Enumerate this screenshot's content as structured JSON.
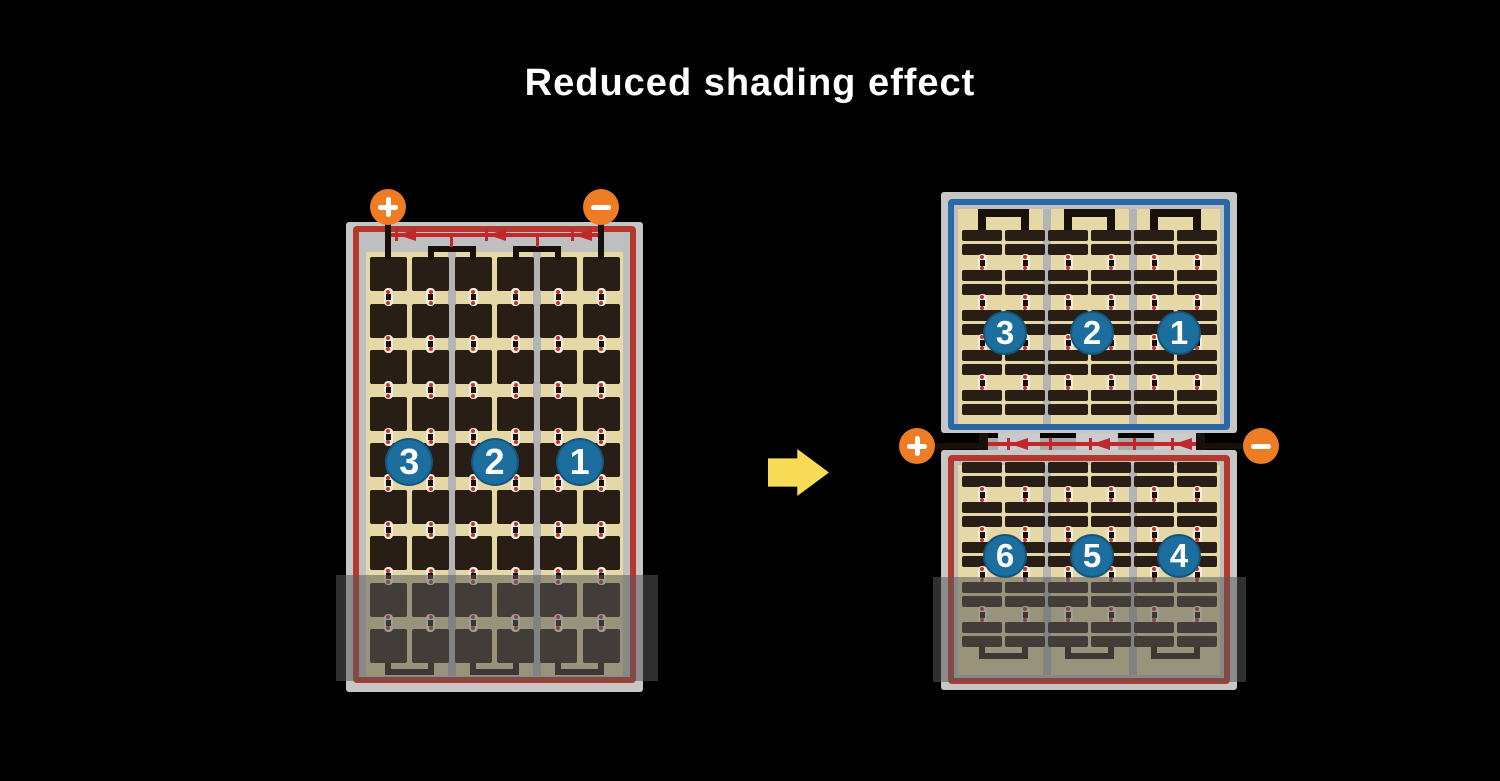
{
  "title": "Reduced shading effect",
  "colors": {
    "background": "#000000",
    "title_text": "#FFFFFF",
    "panel_frame": "#C6C6C6",
    "panel_inner": "#BFBFBF",
    "cell_field_tan": "#E6D8A6",
    "cell_dark": "#281E15",
    "divider_gray": "#B4B4B4",
    "border_red": "#B5382D",
    "border_blue": "#2A68A6",
    "wire_red": "#C1282D",
    "wire_black": "#17100B",
    "terminal_orange": "#EE7C25",
    "string_badge_blue": "#1C6E9E",
    "connector_white": "#F2EDDE",
    "connector_red": "#C3322A",
    "connector_black": "#191009",
    "junction_link_gray": "#A9A9A9",
    "junction_pad_gray": "#CACACA",
    "arrow_yellow": "#F8DC57",
    "shade_overlay": "rgba(88,88,88,0.54)"
  },
  "left_figure": {
    "panel": {
      "border_color": "red",
      "sections": 3,
      "columns_per_section": 2,
      "cell_rows": 9,
      "cell_type": "full-cell",
      "strings": [
        {
          "label": "3"
        },
        {
          "label": "2"
        },
        {
          "label": "1"
        }
      ],
      "bypass_diodes": 3,
      "shaded_bottom": true
    },
    "terminals": {
      "positive_label": "+",
      "negative_label": "−"
    }
  },
  "arrow": {
    "icon": "right-arrow"
  },
  "right_figure": {
    "top_panel": {
      "border_color": "blue",
      "sections": 3,
      "columns_per_section": 2,
      "cell_rows": 10,
      "cell_type": "half-cell",
      "strings": [
        {
          "label": "3"
        },
        {
          "label": "2"
        },
        {
          "label": "1"
        }
      ],
      "shaded_bottom": false
    },
    "bottom_panel": {
      "border_color": "red",
      "sections": 3,
      "columns_per_section": 2,
      "cell_rows": 10,
      "cell_type": "half-cell",
      "strings": [
        {
          "label": "6"
        },
        {
          "label": "5"
        },
        {
          "label": "4"
        }
      ],
      "shaded_bottom": true
    },
    "junction": {
      "bypass_diodes": 3,
      "terminals": {
        "positive_label": "+",
        "negative_label": "−"
      }
    }
  }
}
